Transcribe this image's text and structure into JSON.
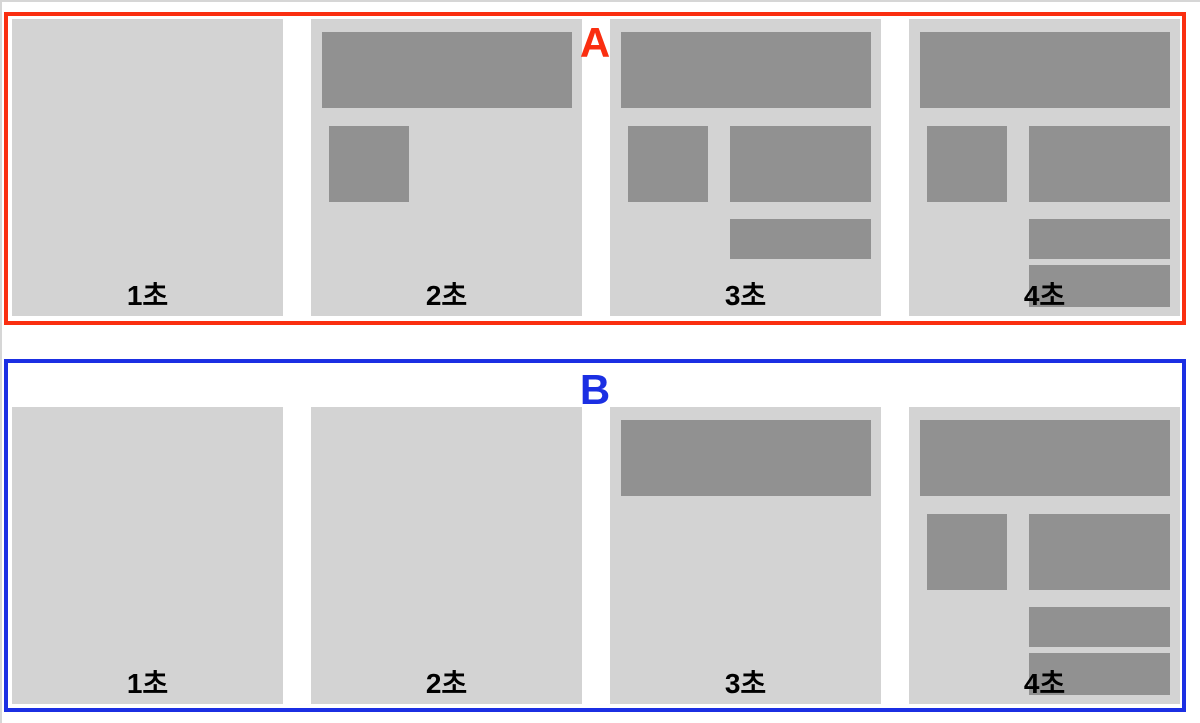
{
  "colors": {
    "frame_bg": "#d3d3d3",
    "block_fill": "#919191",
    "group_a_accent": "#fa2e10",
    "group_b_accent": "#1b2fe3",
    "label_text": "#000000",
    "page_edge": "#d6d6d6",
    "background": "#ffffff"
  },
  "groups": [
    {
      "id": "A",
      "label": "A",
      "accent": "#fa2e10",
      "frames": [
        {
          "time_label": "1초",
          "blocks": []
        },
        {
          "time_label": "2초",
          "blocks": [
            "header",
            "image"
          ]
        },
        {
          "time_label": "3초",
          "blocks": [
            "header",
            "image",
            "content",
            "bar1"
          ]
        },
        {
          "time_label": "4초",
          "blocks": [
            "header",
            "image",
            "content",
            "bar1",
            "bar2"
          ]
        }
      ]
    },
    {
      "id": "B",
      "label": "B",
      "accent": "#1b2fe3",
      "frames": [
        {
          "time_label": "1초",
          "blocks": []
        },
        {
          "time_label": "2초",
          "blocks": []
        },
        {
          "time_label": "3초",
          "blocks": [
            "header"
          ]
        },
        {
          "time_label": "4초",
          "blocks": [
            "header",
            "image",
            "content",
            "bar1",
            "bar2"
          ]
        }
      ]
    }
  ]
}
